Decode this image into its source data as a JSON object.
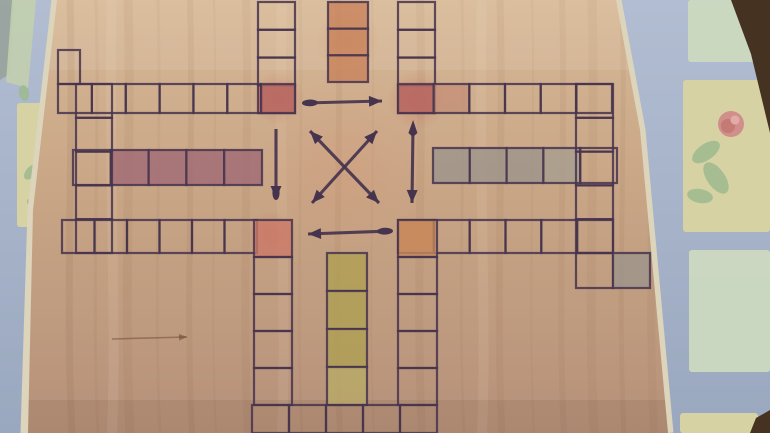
{
  "image": {
    "width": 770,
    "height": 433,
    "type": "photograph",
    "subject": "hand-drawn wooden Ludo / Parcheesi cross game board lying on a table covered with a blue floral oilcloth"
  },
  "palette": {
    "wood_light": "#d6b897",
    "wood": "#c8a585",
    "wood_dark": "#b6917a",
    "ink": "#46344e",
    "red": "#b96a63",
    "red_salmon": "#cb7a68",
    "orange": "#c8825a",
    "orange_corner": "#c78a5e",
    "orange_faint": "#c49077",
    "purple": "#9f6874",
    "gray": "#9b948a",
    "gray_light": "#a69d8f",
    "yellow": "#b0a052",
    "yellow_light": "#b9ab66",
    "cloth_blue": "#a4b0c6",
    "panel_yellow": "#d9d3a2",
    "panel_green": "#c2cfae",
    "panel_green_pale": "#ccd8c0",
    "table_dark": "#463220",
    "edge_cream": "#dcd4bb",
    "flower_pink": "#d18f8b",
    "flower_pink_dark": "#c0766f",
    "leaf_green": "#9cba8e",
    "corner_graygreen": "#98a29b"
  },
  "background": {
    "cloth": {
      "name": "floral-tablecloth",
      "color": "cloth_blue"
    },
    "table_corners": [
      {
        "name": "table-corner-top-right",
        "points": "731,0 770,0 770,133 751,54"
      },
      {
        "name": "table-corner-bottom-right",
        "points": "756,418 770,410 770,433 750,433"
      }
    ],
    "corner_patches": [
      {
        "name": "cloth-graygreen-patch",
        "points": "0,0 14,0 10,74 0,80",
        "color": "corner_graygreen"
      },
      {
        "name": "cloth-green-strip-left",
        "points": "12,0 36,0 28,88 6,82",
        "color": "panel_green"
      }
    ],
    "panels": [
      {
        "name": "left-yellow-panel",
        "x": 17,
        "y": 103,
        "w": 33,
        "h": 124,
        "color": "panel_yellow"
      },
      {
        "name": "right-green-panel-top",
        "x": 688,
        "y": 0,
        "w": 82,
        "h": 62,
        "color": "panel_green_pale"
      },
      {
        "name": "right-yellow-panel",
        "x": 683,
        "y": 80,
        "w": 87,
        "h": 152,
        "color": "panel_yellow"
      },
      {
        "name": "right-green-panel-mid",
        "x": 689,
        "y": 250,
        "w": 81,
        "h": 122,
        "color": "panel_green_pale"
      },
      {
        "name": "right-yellow-sliver",
        "x": 680,
        "y": 413,
        "w": 78,
        "h": 20,
        "color": "panel_yellow"
      }
    ],
    "motifs": [
      {
        "name": "pink-rose",
        "type": "rose",
        "cx": 731,
        "cy": 124,
        "r": 13
      },
      {
        "name": "rose-leaf-1",
        "type": "leaf",
        "cx": 706,
        "cy": 152,
        "rx": 16,
        "ry": 8,
        "rot": -35
      },
      {
        "name": "rose-leaf-2",
        "type": "leaf",
        "cx": 716,
        "cy": 178,
        "rx": 18,
        "ry": 9,
        "rot": 55
      },
      {
        "name": "rose-leaf-3",
        "type": "leaf",
        "cx": 700,
        "cy": 196,
        "rx": 13,
        "ry": 7,
        "rot": 10
      },
      {
        "name": "left-panel-leaf-1",
        "type": "leaf",
        "cx": 31,
        "cy": 172,
        "rx": 9,
        "ry": 5,
        "rot": -50
      },
      {
        "name": "left-panel-leaf-2",
        "type": "leaf",
        "cx": 36,
        "cy": 205,
        "rx": 10,
        "ry": 5,
        "rot": 30
      },
      {
        "name": "left-green-smudge",
        "type": "leaf",
        "cx": 24,
        "cy": 93,
        "rx": 8,
        "ry": 5,
        "rot": 80
      }
    ],
    "board_edge_trim": [
      {
        "name": "board-edge-left",
        "points": "57,0 33,210 26,433"
      },
      {
        "name": "board-edge-right",
        "points": "616,0 640,130 668,433"
      }
    ]
  },
  "board": {
    "outline": "57,0 616,0 640,130 668,433 28,433 33,210",
    "glows": [
      {
        "x": 278,
        "y": 98,
        "r": 27,
        "c": "red"
      },
      {
        "x": 417,
        "y": 100,
        "r": 30,
        "c": "red"
      },
      {
        "x": 272,
        "y": 236,
        "r": 25,
        "c": "red"
      },
      {
        "x": 416,
        "y": 236,
        "r": 23,
        "c": "orange"
      },
      {
        "x": 348,
        "y": 42,
        "r": 32,
        "c": "orange"
      },
      {
        "x": 346,
        "y": 166,
        "r": 90,
        "c": "warm"
      }
    ],
    "ladders": [
      {
        "name": "top-arm-left-strip",
        "o": "v",
        "x": 258,
        "y": 2,
        "w": 37,
        "len": 111,
        "n": 4,
        "colors": [
          null,
          null,
          null,
          "red"
        ]
      },
      {
        "name": "top-arm-middle-strip",
        "o": "v",
        "x": 328,
        "y": 2,
        "w": 40,
        "len": 80,
        "n": 3,
        "colors": [
          "orange",
          "orange",
          "orange"
        ]
      },
      {
        "name": "top-arm-right-strip",
        "o": "v",
        "x": 398,
        "y": 2,
        "w": 37,
        "len": 111,
        "n": 4,
        "colors": [
          null,
          null,
          null,
          "red"
        ]
      },
      {
        "name": "left-arm-top-strip",
        "o": "h",
        "x": 58,
        "y": 84,
        "w": 29,
        "len": 237,
        "n": 7,
        "colors": [
          null,
          null,
          null,
          null,
          null,
          null,
          "red"
        ]
      },
      {
        "name": "left-arm-middle-strip",
        "o": "h",
        "x": 73,
        "y": 150,
        "w": 35,
        "len": 189,
        "n": 5,
        "colors": [
          null,
          "purple",
          "purple",
          "purple",
          "purple"
        ]
      },
      {
        "name": "left-arm-bottom-strip",
        "o": "h",
        "x": 62,
        "y": 220,
        "w": 33,
        "len": 195,
        "n": 6,
        "colors": [
          null,
          null,
          null,
          null,
          null,
          null
        ]
      },
      {
        "name": "left-arm-end-ladder",
        "o": "v",
        "x": 76,
        "y": 84,
        "w": 36,
        "len": 169,
        "n": 5,
        "colors": [
          null,
          null,
          null,
          null,
          null
        ]
      },
      {
        "name": "left-arm-top-ext-cell",
        "o": "v",
        "x": 58,
        "y": 50,
        "w": 22,
        "len": 34,
        "n": 1,
        "colors": [
          null
        ]
      },
      {
        "name": "right-arm-top-strip",
        "o": "h",
        "x": 398,
        "y": 84,
        "w": 29,
        "len": 214,
        "n": 6,
        "colors": [
          "red",
          "orange_faint",
          null,
          null,
          null,
          null
        ]
      },
      {
        "name": "right-arm-middle-strip",
        "o": "h",
        "x": 433,
        "y": 148,
        "w": 35,
        "len": 184,
        "n": 5,
        "colors": [
          "gray",
          "gray",
          "gray",
          "gray_light",
          null
        ]
      },
      {
        "name": "right-arm-bottom-strip",
        "o": "h",
        "x": 398,
        "y": 220,
        "w": 33,
        "len": 215,
        "n": 6,
        "colors": [
          "orange_corner",
          null,
          null,
          null,
          null,
          null
        ]
      },
      {
        "name": "right-arm-end-ladder",
        "o": "v",
        "x": 576,
        "y": 84,
        "w": 37,
        "len": 169,
        "n": 5,
        "colors": [
          null,
          null,
          null,
          null,
          null
        ]
      },
      {
        "name": "right-arm-end-extension",
        "o": "v",
        "x": 576,
        "y": 253,
        "w": 37,
        "len": 35,
        "n": 1,
        "colors": [
          null
        ]
      },
      {
        "name": "right-arm-gray-home-cell",
        "o": "v",
        "x": 613,
        "y": 253,
        "w": 37,
        "len": 35,
        "n": 1,
        "colors": [
          "gray"
        ]
      },
      {
        "name": "bottom-arm-left-strip",
        "o": "v",
        "x": 254,
        "y": 220,
        "w": 38,
        "len": 185,
        "n": 5,
        "colors": [
          "red_salmon",
          null,
          null,
          null,
          null
        ]
      },
      {
        "name": "bottom-arm-middle-strip",
        "o": "v",
        "x": 327,
        "y": 253,
        "w": 40,
        "len": 152,
        "n": 4,
        "colors": [
          "yellow",
          "yellow",
          "yellow",
          "yellow_light"
        ]
      },
      {
        "name": "bottom-arm-right-strip",
        "o": "v",
        "x": 398,
        "y": 220,
        "w": 39,
        "len": 185,
        "n": 5,
        "colors": [
          "orange_corner",
          null,
          null,
          null,
          null
        ]
      },
      {
        "name": "bottom-edge-row",
        "o": "h",
        "x": 252,
        "y": 405,
        "w": 28,
        "len": 185,
        "n": 5,
        "colors": [
          null,
          null,
          null,
          null,
          null
        ]
      }
    ],
    "arrows": [
      {
        "name": "center-top-arrow",
        "x1": 305,
        "y1": 103,
        "x2": 382,
        "y2": 101,
        "head": "end",
        "tail": "blob"
      },
      {
        "name": "center-bottom-arrow",
        "x1": 390,
        "y1": 231,
        "x2": 308,
        "y2": 234,
        "head": "end",
        "tail": "blob"
      },
      {
        "name": "center-left-down-arrow",
        "x1": 276,
        "y1": 129,
        "x2": 276,
        "y2": 199,
        "head": "blob",
        "tail": "none"
      },
      {
        "name": "center-right-down-arrow",
        "x1": 413,
        "y1": 127,
        "x2": 412,
        "y2": 203,
        "head": "end",
        "tail": "fletch"
      },
      {
        "name": "center-diagonal-arrow-ne",
        "x1": 312,
        "y1": 203,
        "x2": 377,
        "y2": 131,
        "head": "both"
      },
      {
        "name": "center-diagonal-arrow-se",
        "x1": 310,
        "y1": 131,
        "x2": 379,
        "y2": 203,
        "head": "both"
      },
      {
        "name": "faint-wood-arrow",
        "x1": 112,
        "y1": 339,
        "x2": 187,
        "y2": 337,
        "head": "end",
        "faint": true
      }
    ]
  }
}
